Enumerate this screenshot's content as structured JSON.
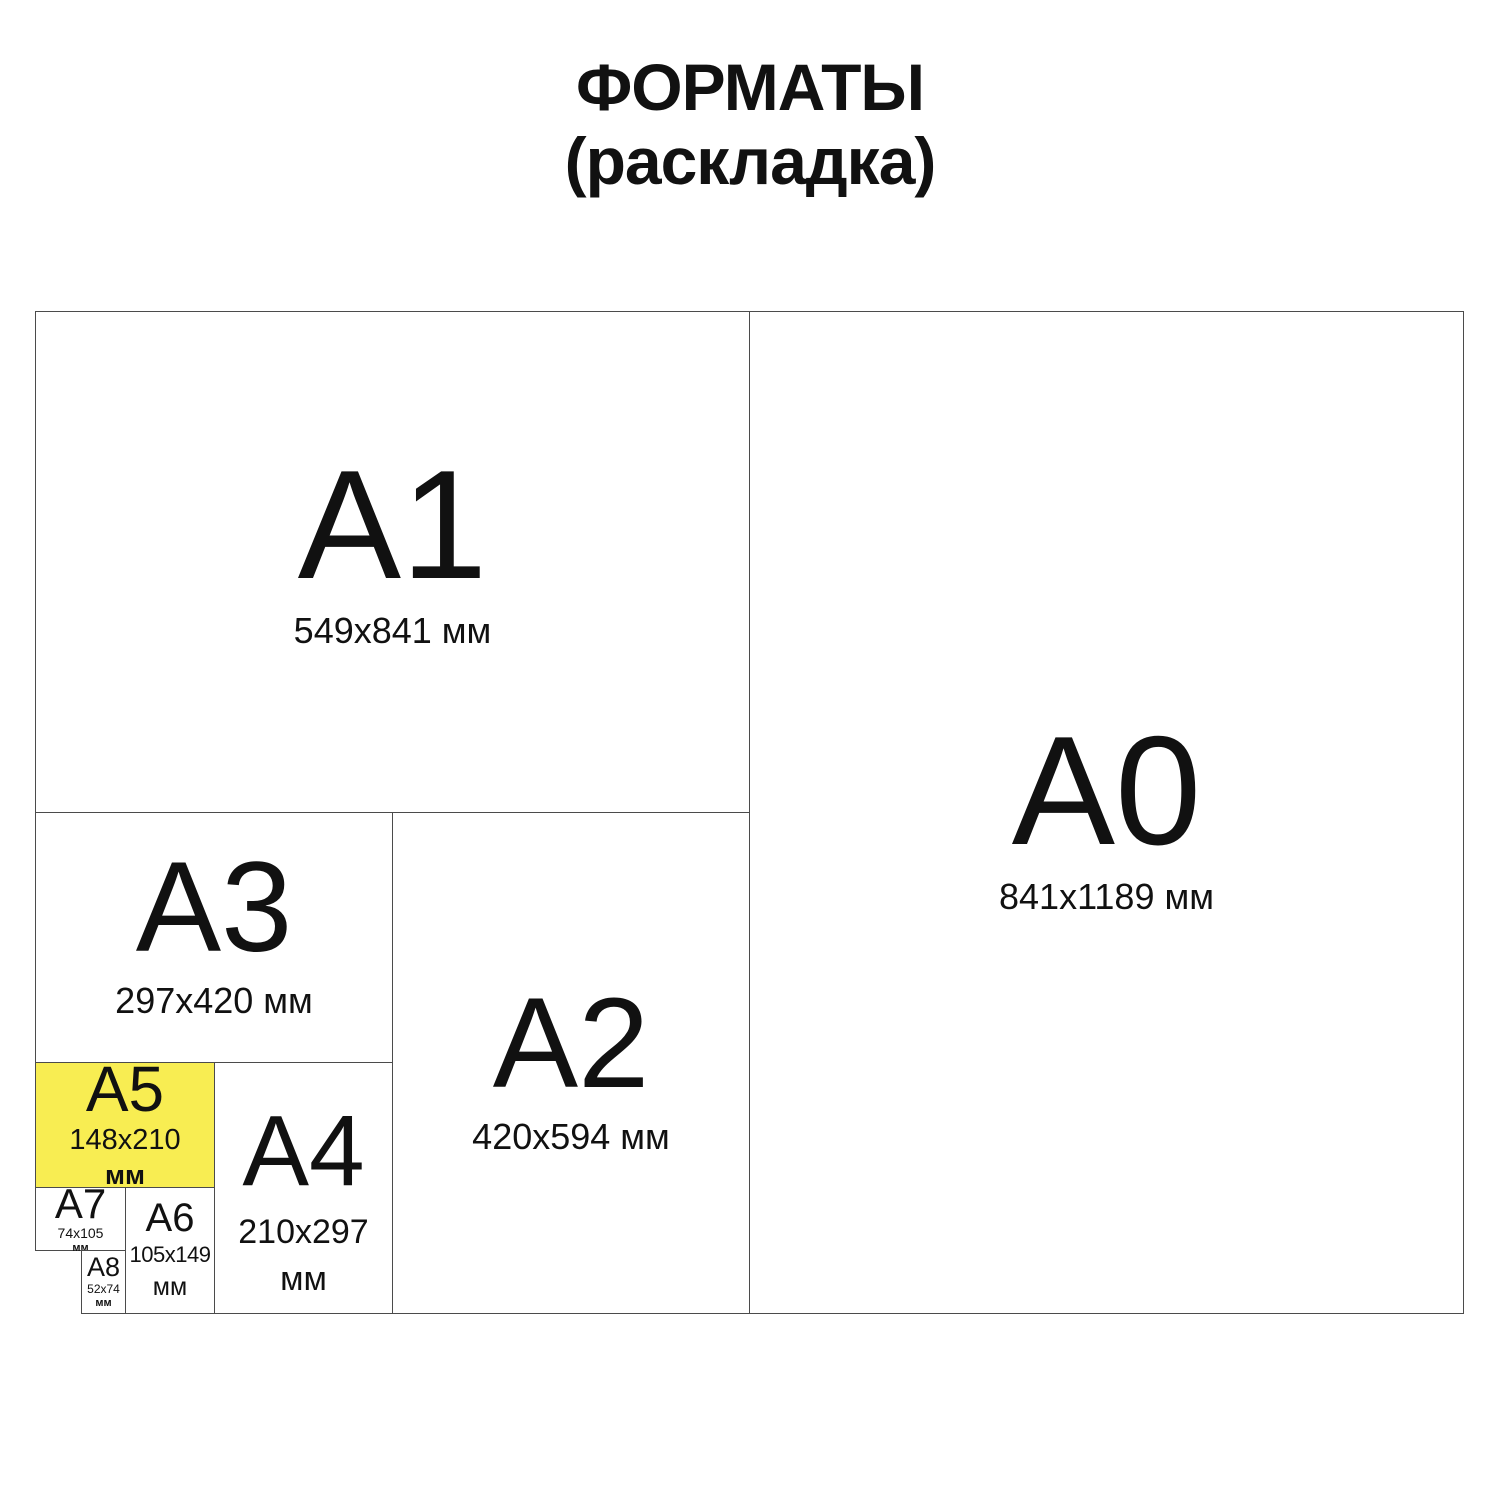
{
  "title": {
    "line1": "ФОРМАТЫ",
    "line2": "(раскладка)"
  },
  "colors": {
    "highlight": "#F8ED52",
    "border": "#4b4b4b",
    "text": "#111111",
    "background": "#ffffff"
  },
  "formats": {
    "a0": {
      "label": "A0",
      "dims": "841x1189 мм"
    },
    "a1": {
      "label": "A1",
      "dims": "549x841 мм"
    },
    "a2": {
      "label": "A2",
      "dims": "420x594 мм"
    },
    "a3": {
      "label": "A3",
      "dims": "297x420 мм"
    },
    "a4": {
      "label": "A4",
      "dims": "210x297",
      "unit": "мм"
    },
    "a5": {
      "label": "A5",
      "dims": "148x210",
      "unit": "мм",
      "highlighted": true
    },
    "a6": {
      "label": "A6",
      "dims": "105x149",
      "unit": "мм"
    },
    "a7": {
      "label": "A7",
      "dims": "74x105",
      "unit": "мм"
    },
    "a8": {
      "label": "A8",
      "dims": "52x74",
      "unit": "мм"
    }
  }
}
